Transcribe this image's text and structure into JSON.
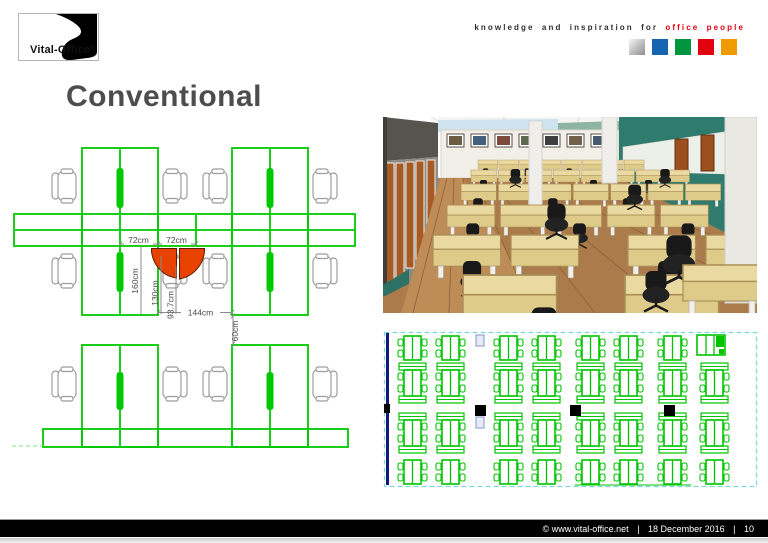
{
  "slide": {
    "title": "Conventional"
  },
  "header": {
    "brand": "Vital-Office",
    "registered": "®",
    "tagline_prefix": "knowledge and inspiration for",
    "tagline_highlight": "office people",
    "square_styles": [
      "background:linear-gradient(135deg,#f5f5f5 0%,#c6c6c6 45%,#8d8d8d 100%)",
      "background:#1565b0",
      "background:#009640",
      "background:#e3000f",
      "background:#ef9b00"
    ]
  },
  "cad": {
    "dim_72_left": "72cm",
    "dim_72_right": "72cm",
    "dim_160": "160cm",
    "dim_130": "130cm",
    "dim_93": "93.7cm",
    "dim_144": "144cm",
    "dim_60": "60cm",
    "line_color": "#00c800",
    "accent_color": "#e84200"
  },
  "floor_plan": {
    "line_color": "#00c400",
    "border_color": "#7fd8d8",
    "wall_color": "#15157e"
  },
  "footer": {
    "copyright": "©  www.vital-office.net",
    "sep1": "|",
    "date": "18 December 2016",
    "sep2": "|",
    "page": "10"
  }
}
